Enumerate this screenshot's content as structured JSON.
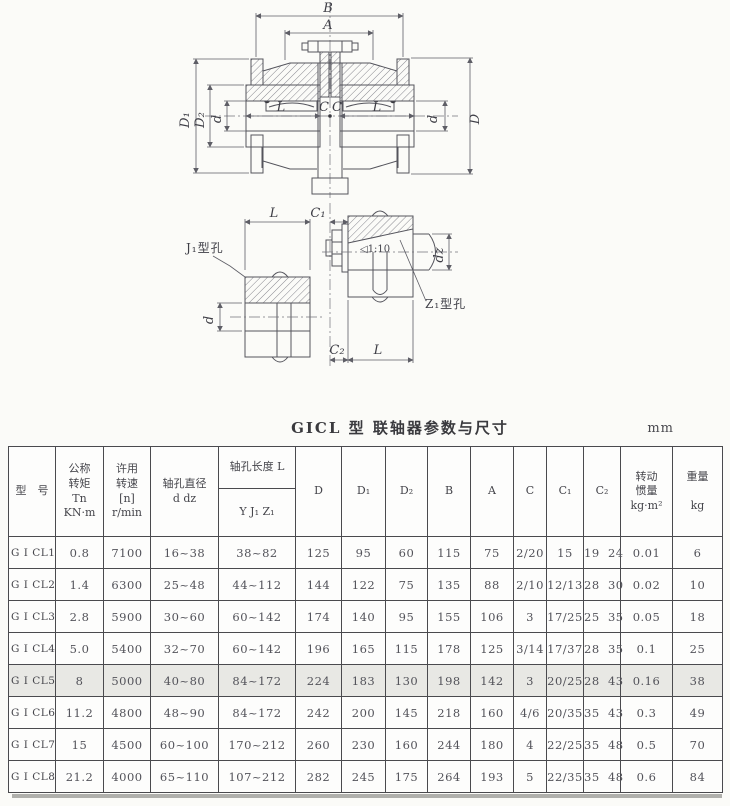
{
  "title": "GICL 型 联轴器参数与尺寸",
  "unit": "mm",
  "drawings": {
    "main": {
      "B": "B",
      "A": "A",
      "D1": "D₁",
      "D2": "D₂",
      "d_left": "d",
      "L_left": "L",
      "C_left": "C",
      "C_right": "C",
      "L_right": "L",
      "d_right": "d",
      "D": "D"
    },
    "detail": {
      "L_top": "L",
      "C1": "C₁",
      "J1_label": "J₁型孔",
      "d": "d",
      "taper": "◁1:10",
      "dz": "dz",
      "Z1_label": "Z₁型孔",
      "C2": "C₂",
      "L_bottom": "L"
    }
  },
  "table": {
    "headers": {
      "model": "型　号",
      "torque": "公称\n转矩\nTn\nKN·m",
      "speed": "许用\n转速\n[n]\nr/min",
      "bore": "轴孔直径\nd dz",
      "length_group": "轴孔长度 L",
      "length_sub": "Y J₁ Z₁",
      "D": "D",
      "D1": "D₁",
      "D2": "D₂",
      "B": "B",
      "A": "A",
      "C": "C",
      "C1": "C₁",
      "C2": "C₂",
      "inertia": "转动\n惯量\nkg·m²",
      "weight": "重量\n\nkg"
    },
    "rows": [
      {
        "model": "G I CL1",
        "tn": "0.8",
        "n": "7100",
        "d": "16~38",
        "L": "38~82",
        "D": "125",
        "D1": "95",
        "D2": "60",
        "B": "115",
        "A": "75",
        "C": "2/20",
        "C1": "15",
        "C2": "19  24",
        "J": "0.01",
        "wt": "6",
        "highlight": false
      },
      {
        "model": "G I CL2",
        "tn": "1.4",
        "n": "6300",
        "d": "25~48",
        "L": "44~112",
        "D": "144",
        "D1": "122",
        "D2": "75",
        "B": "135",
        "A": "88",
        "C": "2/10",
        "C1": "12/13",
        "C2": "28  30",
        "J": "0.02",
        "wt": "10",
        "highlight": false
      },
      {
        "model": "G I CL3",
        "tn": "2.8",
        "n": "5900",
        "d": "30~60",
        "L": "60~142",
        "D": "174",
        "D1": "140",
        "D2": "95",
        "B": "155",
        "A": "106",
        "C": "3",
        "C1": "17/25",
        "C2": "25  35",
        "J": "0.05",
        "wt": "18",
        "highlight": false
      },
      {
        "model": "G I CL4",
        "tn": "5.0",
        "n": "5400",
        "d": "32~70",
        "L": "60~142",
        "D": "196",
        "D1": "165",
        "D2": "115",
        "B": "178",
        "A": "125",
        "C": "3/14",
        "C1": "17/37",
        "C2": "28  35",
        "J": "0.1",
        "wt": "25",
        "highlight": false
      },
      {
        "model": "G I CL5",
        "tn": "8",
        "n": "5000",
        "d": "40~80",
        "L": "84~172",
        "D": "224",
        "D1": "183",
        "D2": "130",
        "B": "198",
        "A": "142",
        "C": "3",
        "C1": "20/25",
        "C2": "28  43",
        "J": "0.16",
        "wt": "38",
        "highlight": true
      },
      {
        "model": "G I CL6",
        "tn": "11.2",
        "n": "4800",
        "d": "48~90",
        "L": "84~172",
        "D": "242",
        "D1": "200",
        "D2": "145",
        "B": "218",
        "A": "160",
        "C": "4/6",
        "C1": "20/35",
        "C2": "35  43",
        "J": "0.3",
        "wt": "49",
        "highlight": false
      },
      {
        "model": "G I CL7",
        "tn": "15",
        "n": "4500",
        "d": "60~100",
        "L": "170~212",
        "D": "260",
        "D1": "230",
        "D2": "160",
        "B": "244",
        "A": "180",
        "C": "4",
        "C1": "22/25",
        "C2": "35  48",
        "J": "0.5",
        "wt": "70",
        "highlight": false
      },
      {
        "model": "G I CL8",
        "tn": "21.2",
        "n": "4000",
        "d": "65~110",
        "L": "107~212",
        "D": "282",
        "D1": "245",
        "D2": "175",
        "B": "264",
        "A": "193",
        "C": "5",
        "C1": "22/35",
        "C2": "35  48",
        "J": "0.6",
        "wt": "84",
        "highlight": false
      }
    ]
  }
}
